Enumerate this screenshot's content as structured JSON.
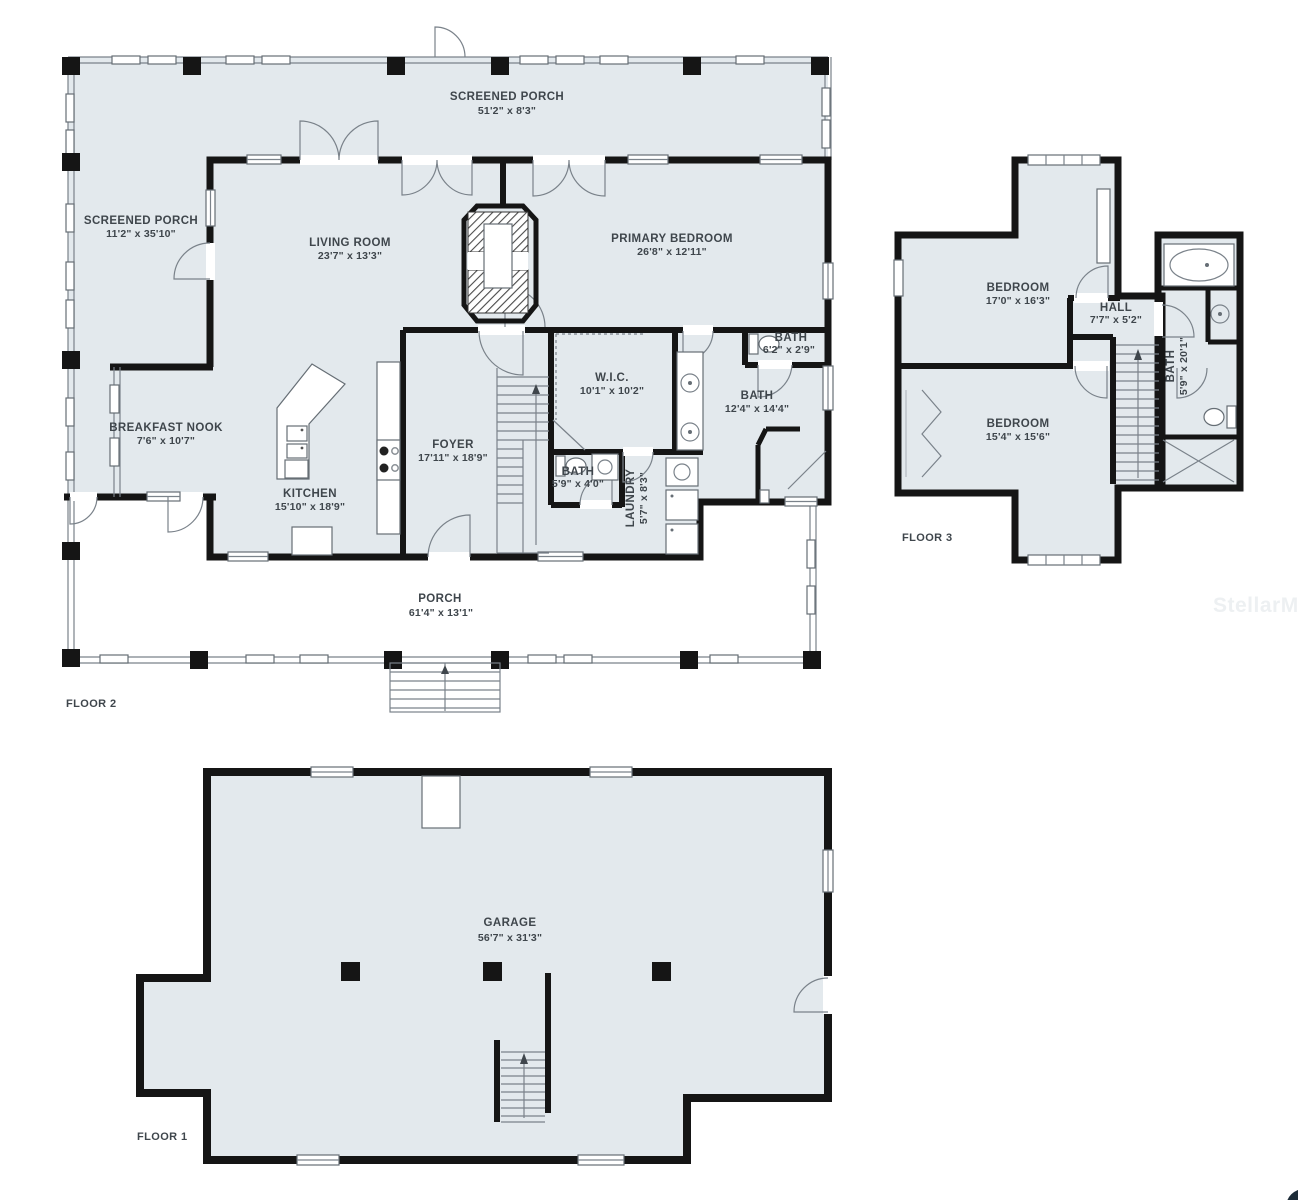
{
  "watermark": "StellarMLS",
  "colors": {
    "floor_fill": "#e3e9ed",
    "wall": "#151515",
    "line": "#7a828a",
    "text": "#3f464c",
    "watermark_text": "#edf0f2",
    "corner_mark": "#1d2c38",
    "background": "#ffffff"
  },
  "plans": {
    "floor2": {
      "label": "FLOOR 2",
      "rooms": {
        "screened_porch_top": {
          "name": "SCREENED PORCH",
          "dims": "51'2\" x 8'3\""
        },
        "screened_porch_left": {
          "name": "SCREENED PORCH",
          "dims": "11'2\" x 35'10\""
        },
        "living_room": {
          "name": "LIVING ROOM",
          "dims": "23'7\" x 13'3\""
        },
        "primary_bedroom": {
          "name": "PRIMARY BEDROOM",
          "dims": "26'8\" x 12'11\""
        },
        "breakfast_nook": {
          "name": "BREAKFAST NOOK",
          "dims": "7'6\" x 10'7\""
        },
        "kitchen": {
          "name": "KITCHEN",
          "dims": "15'10\" x 18'9\""
        },
        "foyer": {
          "name": "FOYER",
          "dims": "17'11\" x 18'9\""
        },
        "wic": {
          "name": "W.I.C.",
          "dims": "10'1\" x 10'2\""
        },
        "bath_toilet_room": {
          "name": "BATH",
          "dims": "6'2\" x 2'9\""
        },
        "bath_primary": {
          "name": "BATH",
          "dims": "12'4\" x 14'4\""
        },
        "bath_hall": {
          "name": "BATH",
          "dims": "5'9\" x 4'0\""
        },
        "laundry": {
          "name": "LAUNDRY",
          "dims": "5'7\" x 8'3\""
        },
        "porch": {
          "name": "PORCH",
          "dims": "61'4\" x 13'1\""
        }
      }
    },
    "floor3": {
      "label": "FLOOR 3",
      "rooms": {
        "bedroom_upper": {
          "name": "BEDROOM",
          "dims": "17'0\" x 16'3\""
        },
        "hall": {
          "name": "HALL",
          "dims": "7'7\" x 5'2\""
        },
        "bedroom_lower": {
          "name": "BEDROOM",
          "dims": "15'4\" x 15'6\""
        },
        "bath": {
          "name": "BATH",
          "dims": "5'9\" x 20'1\""
        }
      }
    },
    "floor1": {
      "label": "FLOOR 1",
      "rooms": {
        "garage": {
          "name": "GARAGE",
          "dims": "56'7\" x 31'3\""
        }
      }
    }
  }
}
